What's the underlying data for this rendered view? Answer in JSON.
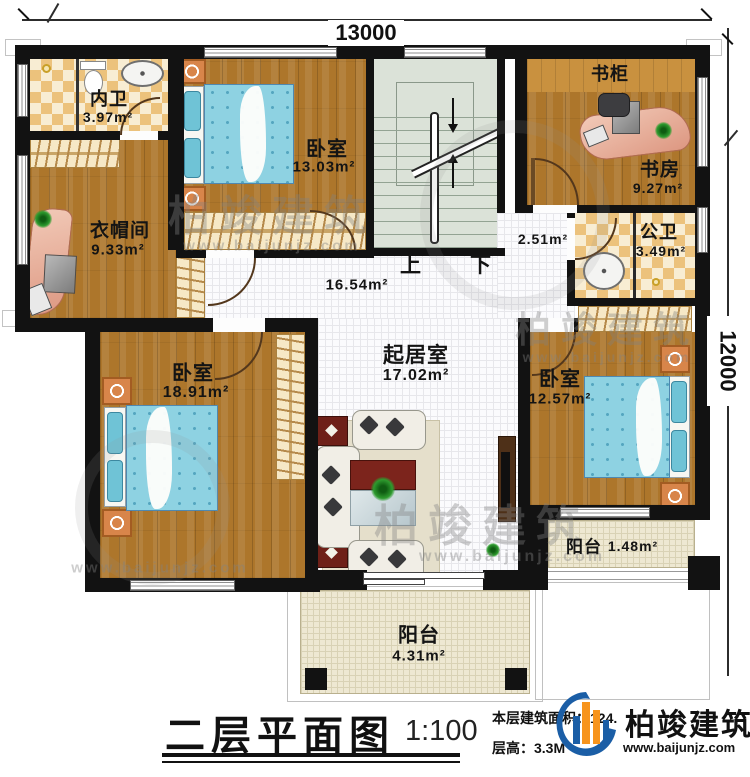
{
  "dimensions": {
    "top": "13000",
    "right": "12000"
  },
  "rooms": {
    "inner_bath": {
      "name": "内卫",
      "area": "3.97m²"
    },
    "bedroom_top": {
      "name": "卧室",
      "area": "13.03m²"
    },
    "bookcase": {
      "name": "书柜"
    },
    "study": {
      "name": "书房",
      "area": "9.27m²"
    },
    "public_bath": {
      "name": "公卫",
      "area": "3.49m²"
    },
    "cloakroom": {
      "name": "衣帽间",
      "area": "9.33m²"
    },
    "hall_small": {
      "area": "2.51m²"
    },
    "hall": {
      "area": "16.54m²"
    },
    "living": {
      "name": "起居室",
      "area": "17.02m²"
    },
    "bedroom_left": {
      "name": "卧室",
      "area": "18.91m²"
    },
    "bedroom_right": {
      "name": "卧室",
      "area": "12.57m²"
    },
    "balcony_right": {
      "name": "阳台",
      "area": "1.48m²"
    },
    "balcony_bottom": {
      "name": "阳台",
      "area": "4.31m²"
    }
  },
  "stairs": {
    "up": "上",
    "down": "下"
  },
  "title_block": {
    "title": "二层平面图",
    "scale": "1:100",
    "area_line": "本层建筑面积：124.",
    "height_line": "层高：3.3M"
  },
  "brand": {
    "name": "柏竣建筑",
    "site": "www.baijunjz.com"
  },
  "watermark": {
    "name": "柏竣建筑",
    "site": "www.baijunjz.com"
  }
}
